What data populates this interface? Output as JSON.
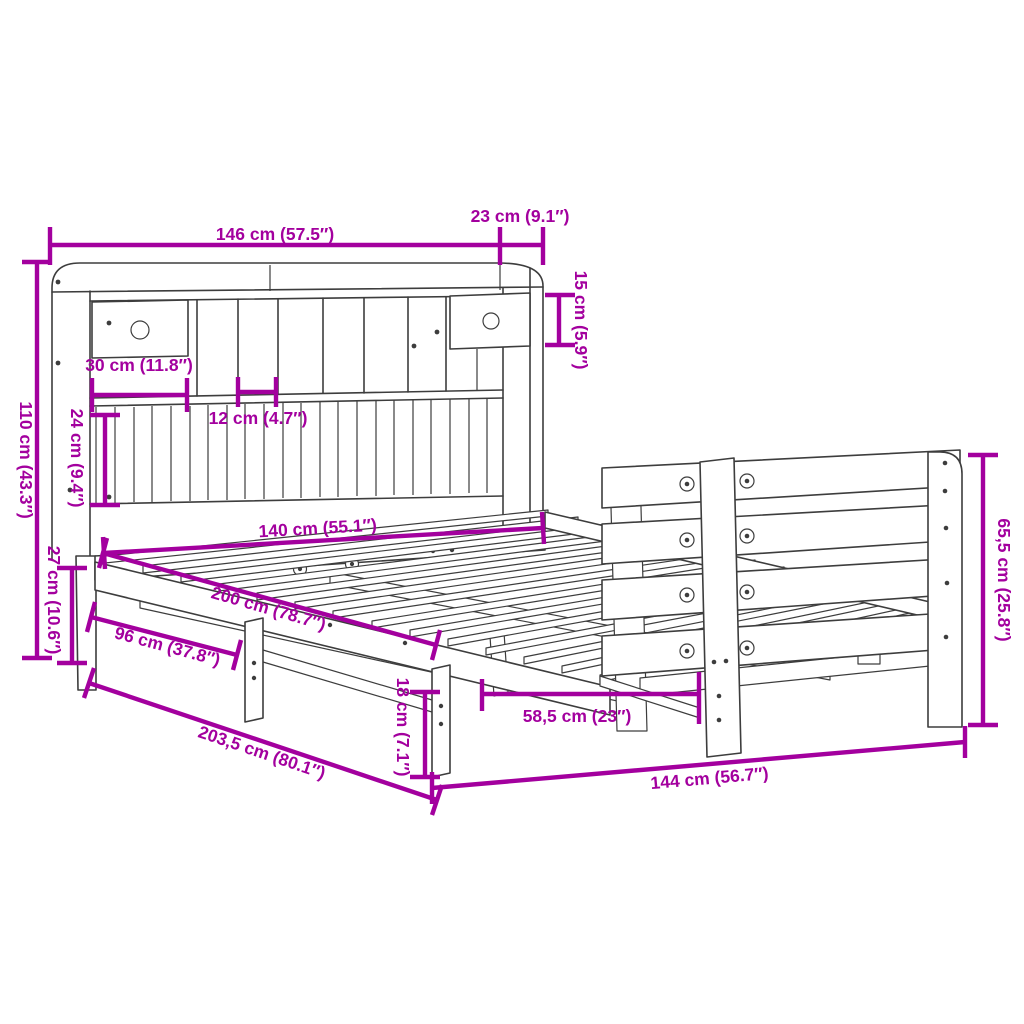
{
  "diagram": {
    "type": "product-dimension-diagram",
    "subject": "bookcase-bed-with-headboard-storage",
    "colors": {
      "dimension": "#A3009E",
      "line": "#3d3d3d",
      "background": "#ffffff"
    },
    "labels": {
      "width_total": "146 cm (57.5″)",
      "top_depth": "23 cm (9.1″)",
      "top_shelf_height": "15 cm (5.9″)",
      "headboard_height": "110 cm (43.3″)",
      "drawer_width": "30 cm (11.8″)",
      "lower_shelf_height": "24 cm (9.4″)",
      "cubby_width": "12 cm (4.7″)",
      "bed_width": "140 cm (55.1″)",
      "frame_height": "27 cm (10.6″)",
      "bed_length": "200 cm (78.7″)",
      "side_rail_length": "96 cm (37.8″)",
      "total_length": "203,5 cm (80.1″)",
      "under_clearance": "18 cm (7.1″)",
      "leg_spacing": "58,5 cm (23″)",
      "footboard_width": "144 cm (56.7″)",
      "footboard_height": "65,5 cm (25.8″)"
    }
  }
}
